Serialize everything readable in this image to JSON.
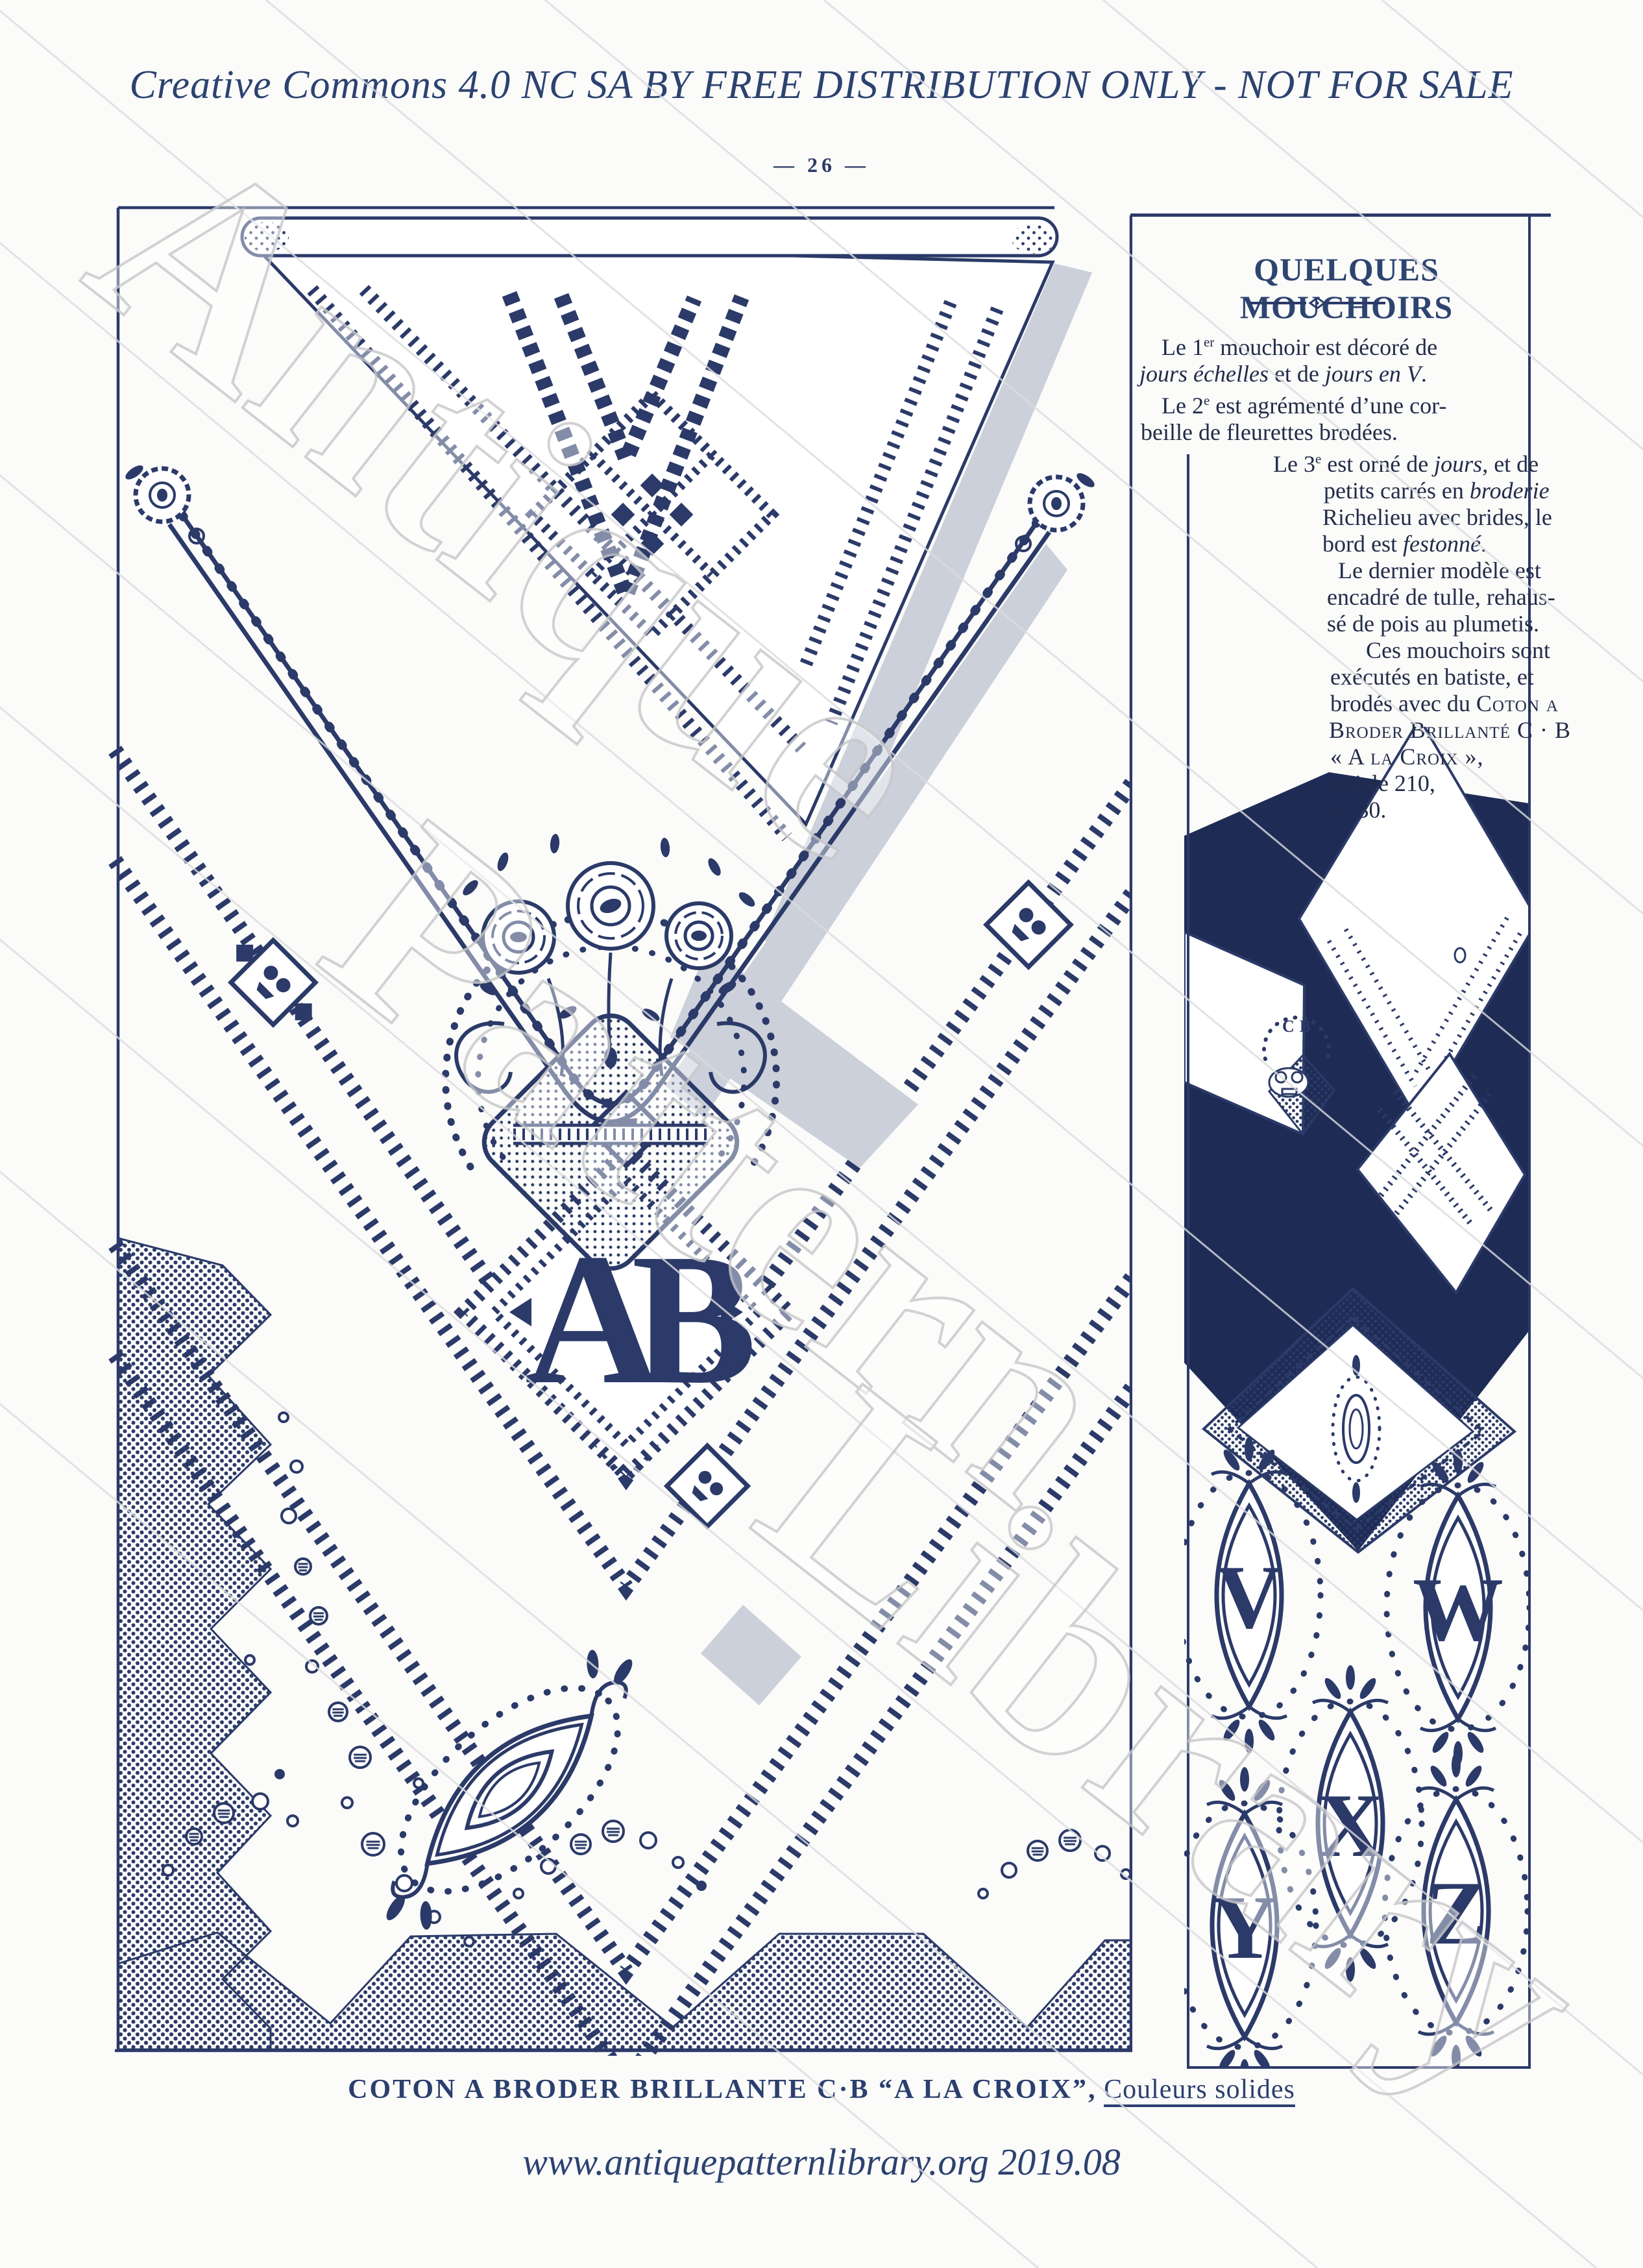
{
  "colors": {
    "ink": "#2b3a68",
    "body_text": "#232c48",
    "title_blue": "#2e4470",
    "photo_panel_navy": "#1e2c55",
    "fold_shadow_gray": "#cbd0da",
    "watermark_gray": "#d9d9db"
  },
  "page": {
    "license": "Creative Commons 4.0 NC SA BY FREE DISTRIBUTION ONLY - NOT FOR SALE",
    "page_number": "— 26 —",
    "footer": "www.antiquepatternlibrary.org  2019.08",
    "caption": {
      "bold": "COTON A  BRODER BRILLANTE C·B “A LA CROIX”,",
      "regular": "Couleurs solides"
    },
    "watermark": [
      "Antique",
      "Pattern",
      "Library"
    ]
  },
  "article": {
    "title": "QUELQUES MOUCHOIRS",
    "paragraphs": [
      {
        "lines": [
          {
            "ml": 34,
            "segs": [
              {
                "t": "Le 1"
              },
              {
                "t": "er",
                "sup": true
              },
              {
                "t": " mouchoir est décoré de"
              }
            ]
          },
          {
            "ml": 0,
            "segs": [
              {
                "t": "jours échelles",
                "i": true
              },
              {
                "t": " et de "
              },
              {
                "t": "jours en V",
                "i": true
              },
              {
                "t": "."
              }
            ]
          }
        ]
      },
      {
        "lines": [
          {
            "ml": 34,
            "segs": [
              {
                "t": "Le 2"
              },
              {
                "t": "e",
                "sup": true
              },
              {
                "t": " est agrémenté d’une cor-"
              }
            ]
          },
          {
            "ml": 2,
            "segs": [
              {
                "t": "beille de fleurettes brodées."
              }
            ]
          }
        ]
      },
      {
        "lines": [
          {
            "ml": 206,
            "segs": [
              {
                "t": "Le 3"
              },
              {
                "t": "e",
                "sup": true
              },
              {
                "t": " est orné de "
              },
              {
                "t": "jours",
                "i": true
              },
              {
                "t": ", et de"
              }
            ]
          },
          {
            "ml": 284,
            "segs": [
              {
                "t": "petits carrés en "
              },
              {
                "t": "broderie",
                "i": true
              }
            ]
          },
          {
            "ml": 282,
            "segs": [
              {
                "t": "Richelieu avec brides, le"
              }
            ]
          },
          {
            "ml": 282,
            "segs": [
              {
                "t": "bord est "
              },
              {
                "t": "festonné",
                "i": true
              },
              {
                "t": "."
              }
            ]
          }
        ]
      },
      {
        "lines": [
          {
            "ml": 306,
            "segs": [
              {
                "t": "Le dernier modèle est"
              }
            ]
          },
          {
            "ml": 289,
            "segs": [
              {
                "t": "encadré de tulle, rehaus-"
              }
            ]
          },
          {
            "ml": 289,
            "segs": [
              {
                "t": "sé de pois au plumetis."
              }
            ]
          }
        ]
      },
      {
        "lines": [
          {
            "ml": 349,
            "segs": [
              {
                "t": "Ces mouchoirs sont"
              }
            ]
          },
          {
            "ml": 294,
            "segs": [
              {
                "t": "exécutés en batiste, et"
              }
            ]
          },
          {
            "ml": 294,
            "segs": [
              {
                "t": "brodés avec du "
              },
              {
                "t": "Coton a",
                "sc": true
              }
            ]
          },
          {
            "ml": 292,
            "segs": [
              {
                "t": "Broder Brillanté C · B",
                "sc": true
              }
            ]
          },
          {
            "ml": 294,
            "segs": [
              {
                "t": "« A la Croix »,",
                "sc": true
              }
            ]
          },
          {
            "ml": 294,
            "segs": [
              {
                "t": "article 210,"
              }
            ]
          },
          {
            "ml": 294,
            "segs": [
              {
                "t": "n° 30."
              }
            ]
          }
        ]
      }
    ]
  },
  "illustration": {
    "center_monogram": "AB",
    "photo_mark": "CB",
    "alphabet_monograms": [
      "V",
      "W",
      "X",
      "Y",
      "Z"
    ]
  }
}
